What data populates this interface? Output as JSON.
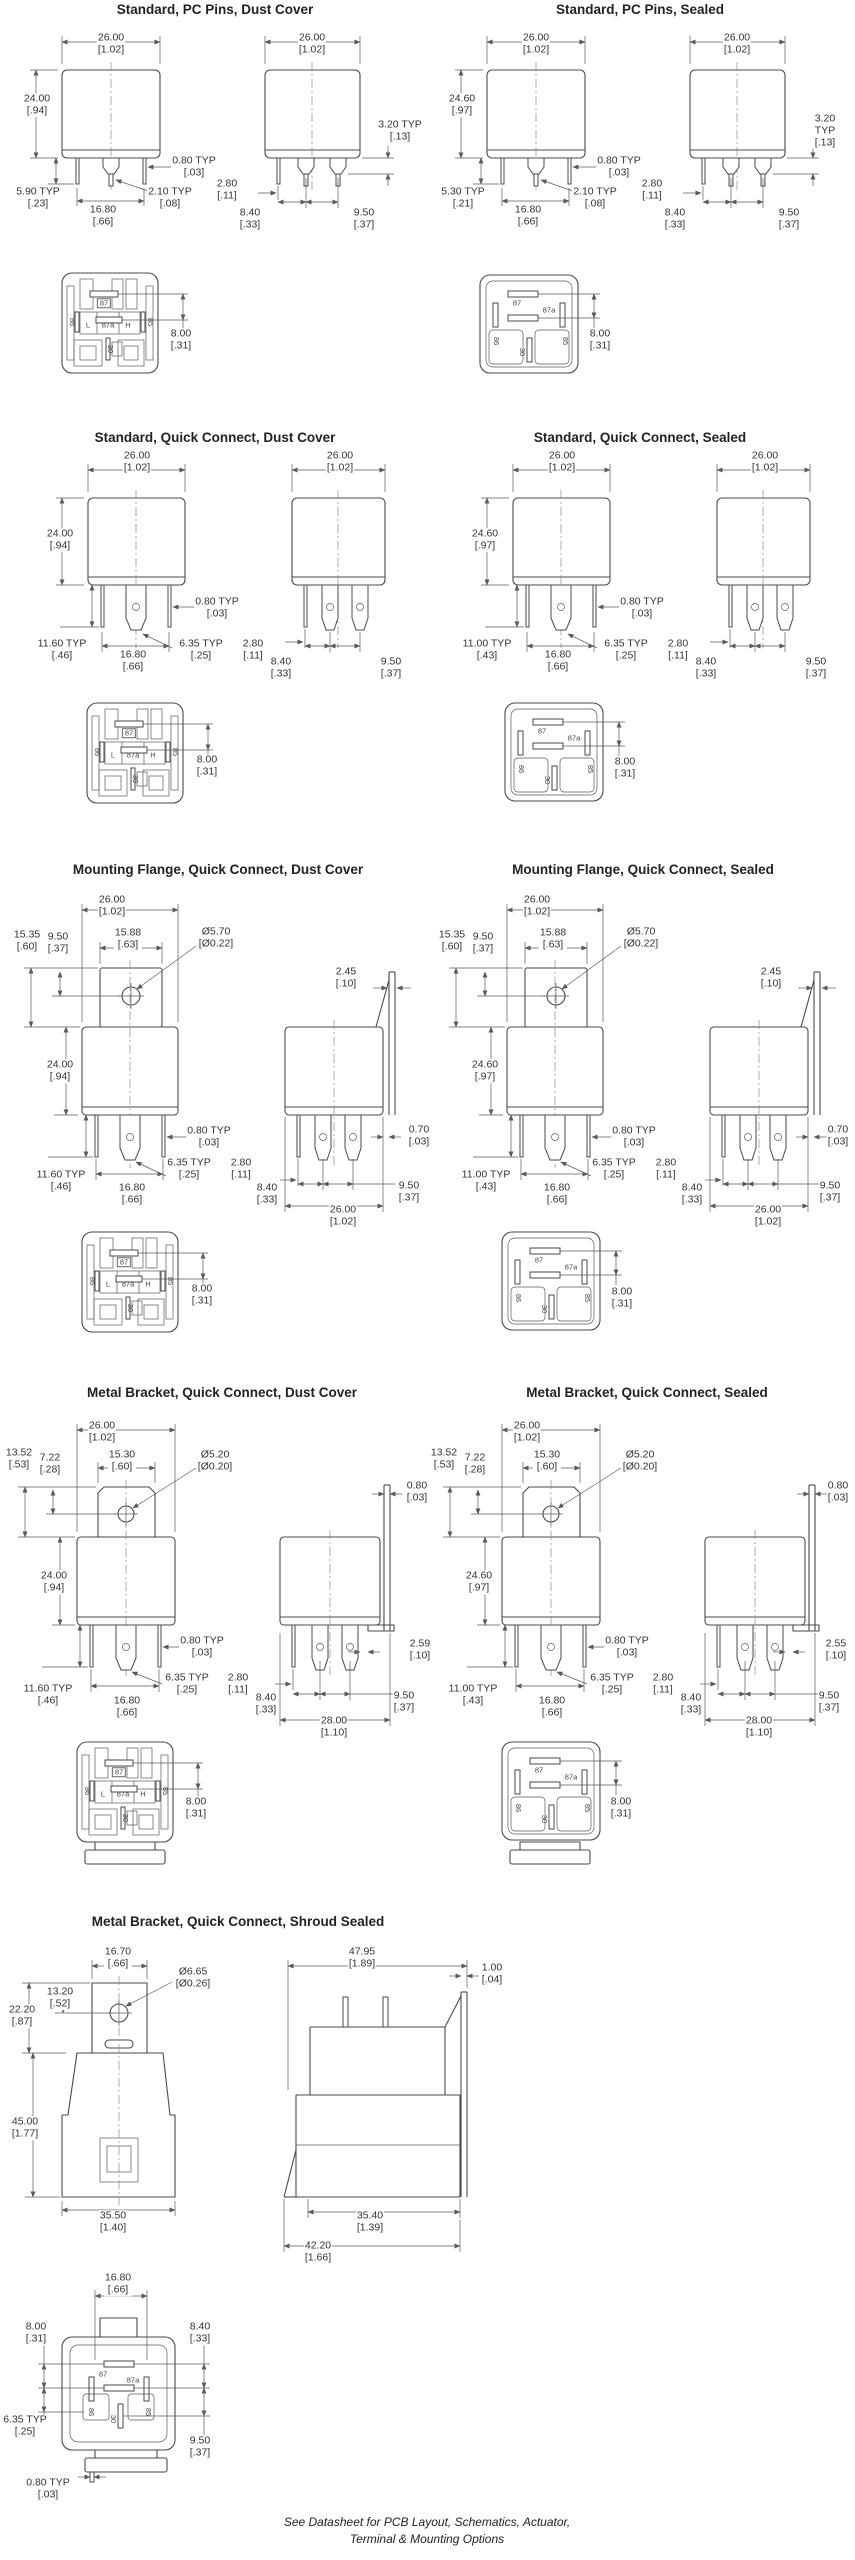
{
  "sections": [
    {
      "title": "Standard, PC Pins, Dust Cover",
      "labels": {
        "front_w": "26.00\n[1.02]",
        "height": "24.00\n[.94]",
        "pin_len": "5.90 TYP\n[.23]",
        "pitch": "16.80\n[.66]",
        "pin_w": "0.80 TYP\n[.03]",
        "pin_t": "2.10 TYP\n[.08]",
        "side_w": "26.00\n[1.02]",
        "tab": "3.20 TYP\n[.13]",
        "gap": "2.80\n[.11]",
        "p1": "8.40\n[.33]",
        "p2": "9.50\n[.37]",
        "bottom": "8.00\n[.31]"
      }
    },
    {
      "title": "Standard, PC Pins, Sealed",
      "labels": {
        "front_w": "26.00\n[1.02]",
        "height": "24.60\n[.97]",
        "pin_len": "5.30 TYP\n[.21]",
        "pitch": "16.80\n[.66]",
        "pin_w": "0.80 TYP\n[.03]",
        "pin_t": "2.10 TYP\n[.08]",
        "side_w": "26.00\n[1.02]",
        "tab": "3.20 TYP\n[.13]",
        "gap": "2.80\n[.11]",
        "p1": "8.40\n[.33]",
        "p2": "9.50\n[.37]",
        "bottom": "8.00\n[.31]"
      }
    },
    {
      "title": "Standard, Quick Connect, Dust Cover",
      "labels": {
        "front_w": "26.00\n[1.02]",
        "height": "24.00\n[.94]",
        "pin_len": "11.60 TYP\n[.46]",
        "pitch": "16.80\n[.66]",
        "pin_w": "0.80 TYP\n[.03]",
        "qc": "6.35 TYP\n[.25]",
        "side_w": "26.00\n[1.02]",
        "gap": "2.80\n[.11]",
        "p1": "8.40\n[.33]",
        "p2": "9.50\n[.37]",
        "bottom": "8.00\n[.31]"
      }
    },
    {
      "title": "Standard, Quick Connect, Sealed",
      "labels": {
        "front_w": "26.00\n[1.02]",
        "height": "24.60\n[.97]",
        "pin_len": "11.00 TYP\n[.43]",
        "pitch": "16.80\n[.66]",
        "pin_w": "0.80 TYP\n[.03]",
        "qc": "6.35 TYP\n[.25]",
        "side_w": "26.00\n[1.02]",
        "gap": "2.80\n[.11]",
        "p1": "8.40\n[.33]",
        "p2": "9.50\n[.37]",
        "bottom": "8.00\n[.31]"
      }
    },
    {
      "title": "Mounting Flange, Quick Connect, Dust Cover",
      "labels": {
        "front_w": "26.00\n[1.02]",
        "flange_h": "15.35\n[.60]",
        "hole_off": "9.50\n[.37]",
        "flange_w": "15.88\n[.63]",
        "hole": "Ø5.70\n[Ø0.22]",
        "height": "24.00\n[.94]",
        "pin_len": "11.60 TYP\n[.46]",
        "pitch": "16.80\n[.66]",
        "pin_w": "0.80 TYP\n[.03]",
        "qc": "6.35 TYP\n[.25]",
        "flange_t": "2.45\n[.10]",
        "tab_t": "0.70\n[.03]",
        "gap": "2.80\n[.11]",
        "p1": "8.40\n[.33]",
        "p2": "9.50\n[.37]",
        "base_w": "26.00\n[1.02]",
        "bottom": "8.00\n[.31]"
      }
    },
    {
      "title": "Mounting Flange, Quick Connect, Sealed",
      "labels": {
        "front_w": "26.00\n[1.02]",
        "flange_h": "15.35\n[.60]",
        "hole_off": "9.50\n[.37]",
        "flange_w": "15.88\n[.63]",
        "hole": "Ø5.70\n[Ø0.22]",
        "height": "24.60\n[.97]",
        "pin_len": "11.00 TYP\n[.43]",
        "pitch": "16.80\n[.66]",
        "pin_w": "0.80 TYP\n[.03]",
        "qc": "6.35 TYP\n[.25]",
        "flange_t": "2.45\n[.10]",
        "tab_t": "0.70\n[.03]",
        "gap": "2.80\n[.11]",
        "p1": "8.40\n[.33]",
        "p2": "9.50\n[.37]",
        "base_w": "26.00\n[1.02]",
        "bottom": "8.00\n[.31]"
      }
    },
    {
      "title": "Metal Bracket, Quick Connect, Dust Cover",
      "labels": {
        "front_w": "26.00\n[1.02]",
        "bracket_h": "13.52\n[.53]",
        "hole_off": "7.22\n[.28]",
        "bracket_w": "15.30\n[.60]",
        "hole": "Ø5.20\n[Ø0.20]",
        "height": "24.00\n[.94]",
        "pin_len": "11.60 TYP\n[.46]",
        "pitch": "16.80\n[.66]",
        "pin_w": "0.80 TYP\n[.03]",
        "qc": "6.35 TYP\n[.25]",
        "bracket_t": "0.80\n[.03]",
        "side_off": "2.59\n[.10]",
        "gap": "2.80\n[.11]",
        "p1": "8.40\n[.33]",
        "p2": "9.50\n[.37]",
        "base_w": "28.00\n[1.10]",
        "bottom": "8.00\n[.31]"
      }
    },
    {
      "title": "Metal Bracket, Quick Connect, Sealed",
      "labels": {
        "front_w": "26.00\n[1.02]",
        "bracket_h": "13.52\n[.53]",
        "hole_off": "7.22\n[.28]",
        "bracket_w": "15.30\n[.60]",
        "hole": "Ø5.20\n[Ø0.20]",
        "height": "24.60\n[.97]",
        "pin_len": "11.00 TYP\n[.43]",
        "pitch": "16.80\n[.66]",
        "pin_w": "0.80 TYP\n[.03]",
        "qc": "6.35 TYP\n[.25]",
        "bracket_t": "0.80\n[.03]",
        "side_off": "2.55\n[.10]",
        "gap": "2.80\n[.11]",
        "p1": "8.40\n[.33]",
        "p2": "9.50\n[.37]",
        "base_w": "28.00\n[1.10]",
        "bottom": "8.00\n[.31]"
      }
    },
    {
      "title": "Metal Bracket, Quick Connect, Shroud Sealed",
      "labels": {
        "bracket_w": "16.70\n[.66]",
        "hole": "Ø6.65\n[Ø0.26]",
        "bracket_h": "22.20\n[.87]",
        "hole_off": "13.20\n[.52]",
        "height": "45.00\n[1.77]",
        "base_w": "35.50\n[1.40]",
        "side_w": "47.95\n[1.89]",
        "shroud_t": "1.00\n[.04]",
        "side_base": "35.40\n[1.39]",
        "side_total": "42.20\n[1.66]",
        "bv_pitch": "16.80\n[.66]",
        "bv_left": "8.00\n[.31]",
        "bv_right": "8.40\n[.33]",
        "bv_qc": "6.35 TYP\n[.25]",
        "bv_p2": "9.50\n[.37]",
        "bv_pin": "0.80 TYP\n[.03]"
      }
    }
  ],
  "pins": {
    "p87": "87",
    "p87a": "87a",
    "pL": "L",
    "pH": "H",
    "p85": "85",
    "p86": "86",
    "p30": "30"
  },
  "footer": {
    "line1": "See Datasheet for PCB Layout, Schematics, Actuator,",
    "line2": "Terminal & Mounting Options"
  }
}
